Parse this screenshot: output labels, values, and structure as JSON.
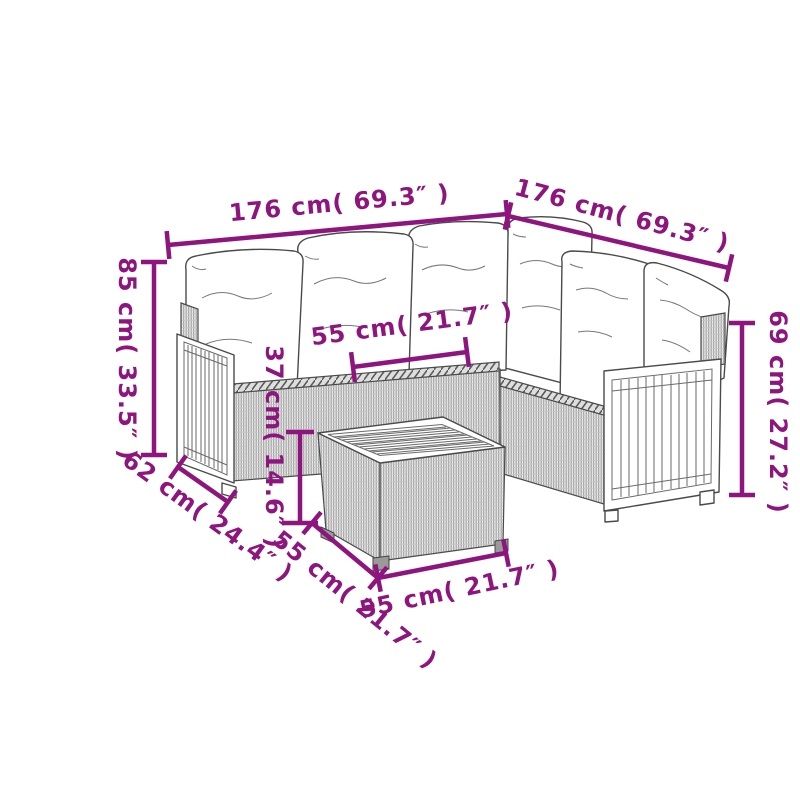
{
  "diagram": {
    "kind": "product-dimension-drawing",
    "subject": "rattan corner sofa set with cushions and square coffee table",
    "colors": {
      "dimension_accent": "#8E157E",
      "line_art": "#4a4a4a",
      "rattan_tone": "#9b9b9b",
      "background": "#ffffff"
    }
  },
  "dims": {
    "sofa_left_length": {
      "label": "176 cm( 69.3″ )",
      "cm": 176,
      "inches": 69.3
    },
    "sofa_right_length": {
      "label": "176 cm( 69.3″ )",
      "cm": 176,
      "inches": 69.3
    },
    "backrest_height": {
      "label": "85 cm( 33.5″ )",
      "cm": 85,
      "inches": 33.5
    },
    "seat_module_width": {
      "label": "55 cm( 21.7″ )",
      "cm": 55,
      "inches": 21.7
    },
    "table_height": {
      "label": "37 cm( 14.6″ )",
      "cm": 37,
      "inches": 14.6
    },
    "armrest_height": {
      "label": "69 cm( 27.2″ )",
      "cm": 69,
      "inches": 27.2
    },
    "seat_depth": {
      "label": "62 cm( 24.4″ )",
      "cm": 62,
      "inches": 24.4
    },
    "table_depth": {
      "label": "55 cm( 21.7″ )",
      "cm": 55,
      "inches": 21.7
    },
    "table_width": {
      "label": "55 cm( 21.7″ )",
      "cm": 55,
      "inches": 21.7
    }
  }
}
